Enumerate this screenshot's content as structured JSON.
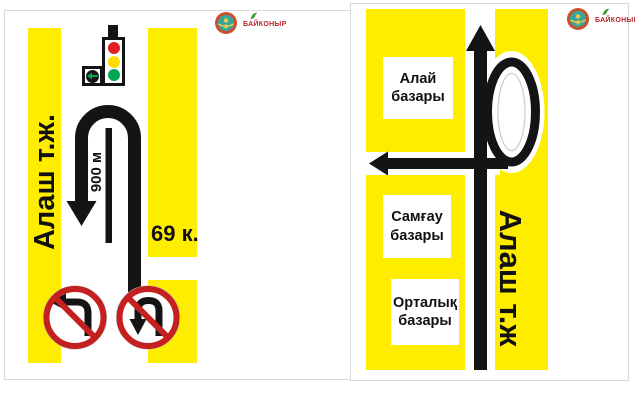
{
  "brand": {
    "name": "БАЙКОНЫР"
  },
  "left_sign": {
    "street": "Алаш т.ж.",
    "distance": "900 м",
    "building": "69 к.",
    "prohibitions": [
      "no-left-turn",
      "no-u-turn"
    ]
  },
  "right_sign": {
    "street": "Алаш т.ж",
    "markets": [
      {
        "line1": "Алай",
        "line2": "базары"
      },
      {
        "line1": "Самғау",
        "line2": "базары"
      },
      {
        "line1": "Орталық",
        "line2": "базары"
      }
    ]
  },
  "colors": {
    "sign_yellow": "#FFED00",
    "route_black": "#141414",
    "prohibition_red": "#C4201F",
    "traffic_red": "#E31E24",
    "traffic_amber": "#FFDD00",
    "traffic_green": "#00A651",
    "brand_red": "#B3282D",
    "emblem_teal": "#35A79C",
    "emblem_ring": "#C8502E"
  }
}
